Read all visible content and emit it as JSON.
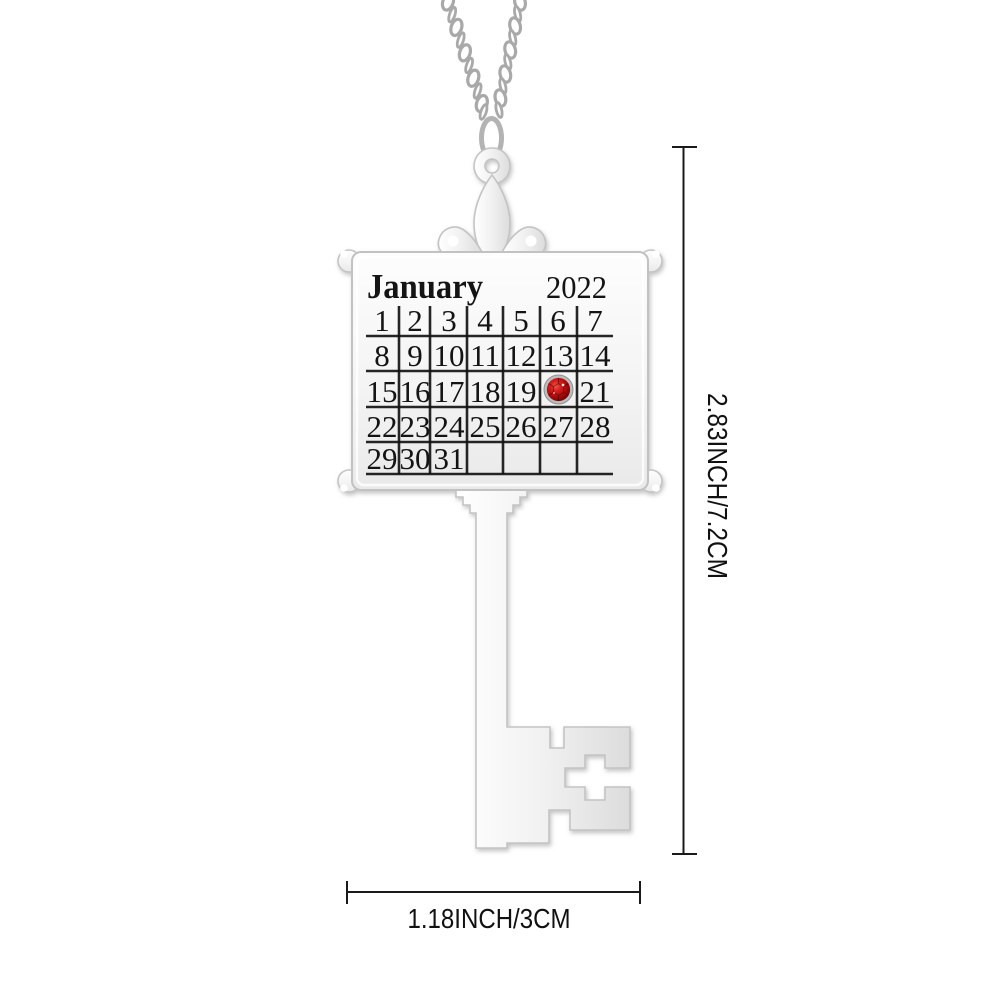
{
  "background": "#ffffff",
  "pendant": {
    "description": "key-shaped calendar pendant necklace",
    "material_colors": {
      "metal_light": "#fdfdfd",
      "metal_mid": "#efefef",
      "metal_shadow": "#dcdcdc",
      "metal_edge": "#c4c4c4"
    },
    "calendar": {
      "month": "January",
      "year": "2022",
      "weeks": [
        [
          "1",
          "2",
          "3",
          "4",
          "5",
          "6",
          "7"
        ],
        [
          "8",
          "9",
          "10",
          "11",
          "12",
          "13",
          "14"
        ],
        [
          "15",
          "16",
          "17",
          "18",
          "19",
          "",
          "21"
        ],
        [
          "22",
          "23",
          "24",
          "25",
          "26",
          "27",
          "28"
        ],
        [
          "29",
          "30",
          "31",
          "",
          "",
          "",
          ""
        ]
      ],
      "gem_on_day_slot": "20",
      "engraving_color": "#141414",
      "gem": {
        "bezel_color": "#bcbcbc",
        "stone_color": "#c01212",
        "stone_dark": "#5f0303"
      }
    }
  },
  "annotations": {
    "line_color": "#1a1a1a",
    "height_label": "2.83INCH/7.2CM",
    "width_label": "1.18INCH/3CM"
  }
}
